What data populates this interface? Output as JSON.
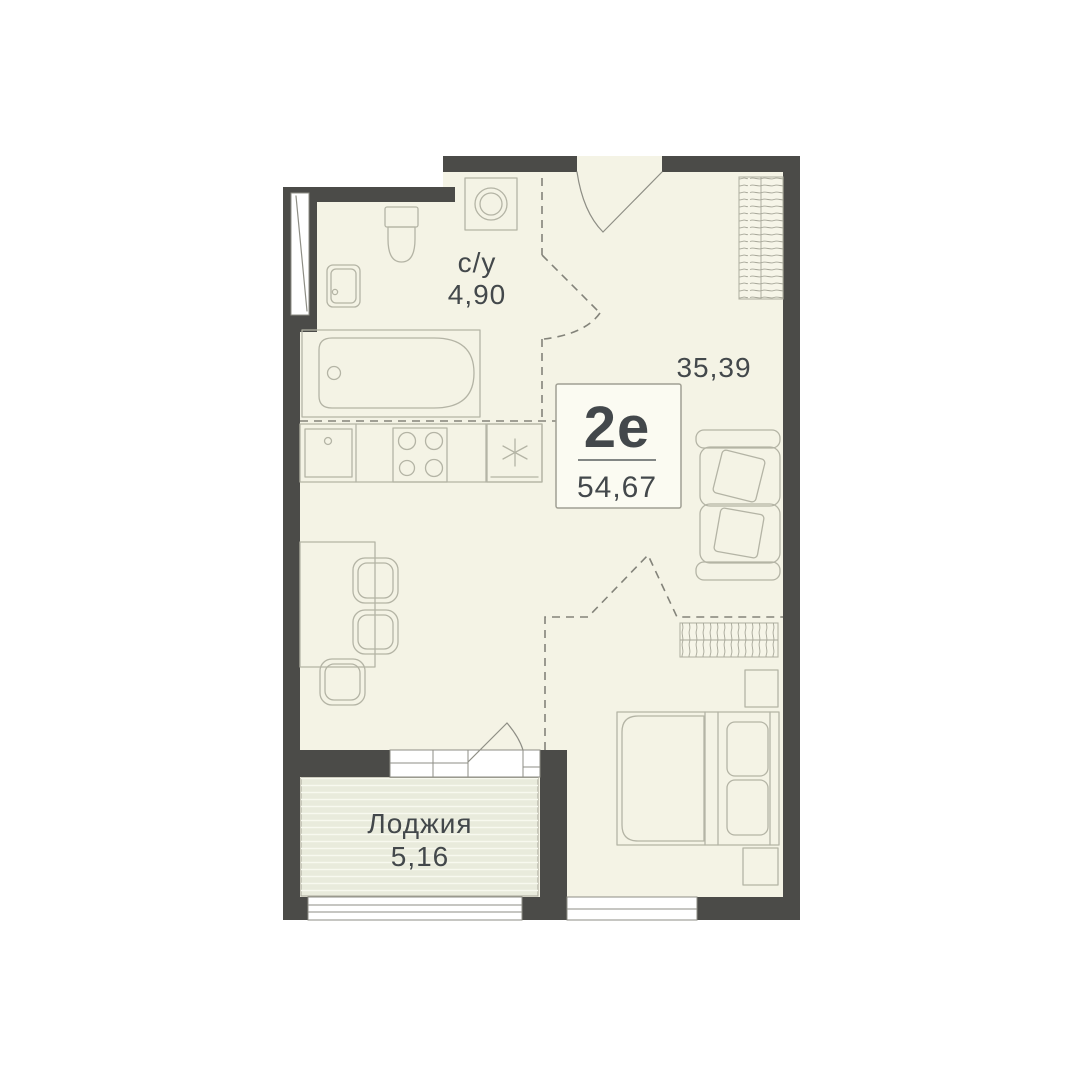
{
  "unit_card": {
    "type": "2е",
    "total_area": "54,67"
  },
  "rooms": {
    "bathroom": {
      "label": "с/у",
      "area": "4,90"
    },
    "main_room": {
      "area": "35,39"
    },
    "loggia": {
      "label": "Лоджия",
      "area": "5,16"
    }
  },
  "colors": {
    "background": "#ffffff",
    "wall": "#4b4b48",
    "floor": "#f4f3e5",
    "loggia-floor": "#e9ebdc",
    "loggia-stripe": "#f8f9ef",
    "wardrobe-bg": "#f6f5e8",
    "furniture-line": "#b4b4a5",
    "fixture-line": "#8e8e85",
    "dashed-line": "#83837a",
    "hatch-line": "#a6a698",
    "label-box-bg": "#fbfbf2",
    "label-box-border": "#a09f93",
    "divider": "#5a5f60",
    "text": "#43484b"
  }
}
